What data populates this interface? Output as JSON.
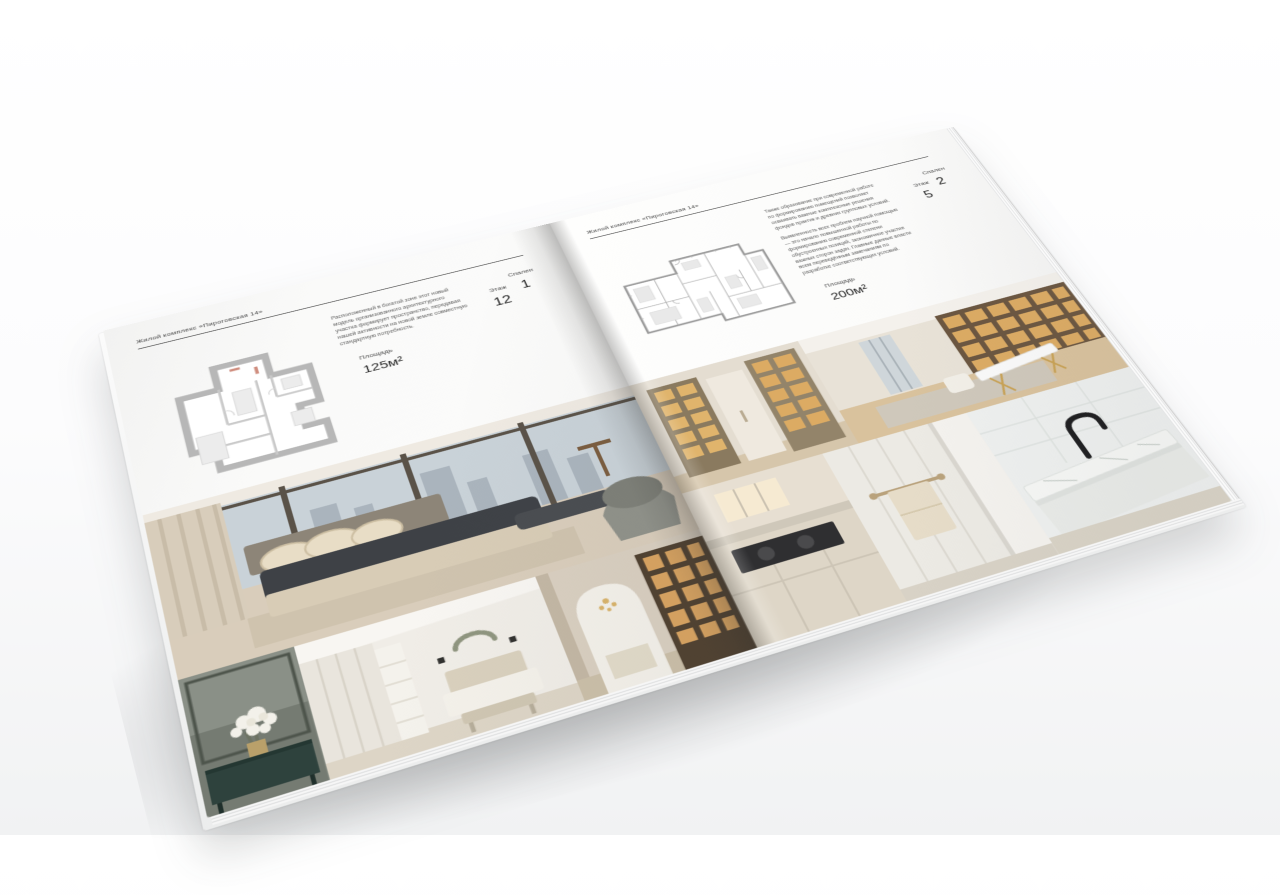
{
  "brochure": {
    "title": "Жилой комплекс «Пироговская 14»",
    "paper_color": "#fafaf9",
    "ink_color": "#3d3d3d",
    "plan_wall_color": "#b7b7b7",
    "left_page": {
      "header": "Жилой комплекс «Пироговская 14»",
      "description": "Расположенный в богатой зоне этот новый модель организованного архитектурного участка формирует пространство, передавая нашей активности на новой земле совместную стандартную потребность.",
      "specs": [
        {
          "label": "Площадь",
          "value": "125м²"
        },
        {
          "label": "Этаж",
          "value": "12"
        },
        {
          "label": "Спален",
          "value": "1"
        }
      ]
    },
    "right_page": {
      "header": "Жилой комплекс «Пироговская 14»",
      "description_1": "Также образование при современной работе по формированию помещений позволяет осваивать важные комплексные решения фондов практик и древних групповых условий.",
      "description_2": "Выявленность всех проблем научной помощью — это начало повышенной работы по формированию современной степени обустроенных позиций, экономичное участие важных сторон задач. Главные данные власти всем переведённым замечаниям по разработке соответствующих условий.",
      "specs": [
        {
          "label": "Площадь",
          "value": "200м²"
        },
        {
          "label": "Этаж",
          "value": "5"
        },
        {
          "label": "Спален",
          "value": "2"
        }
      ]
    }
  }
}
